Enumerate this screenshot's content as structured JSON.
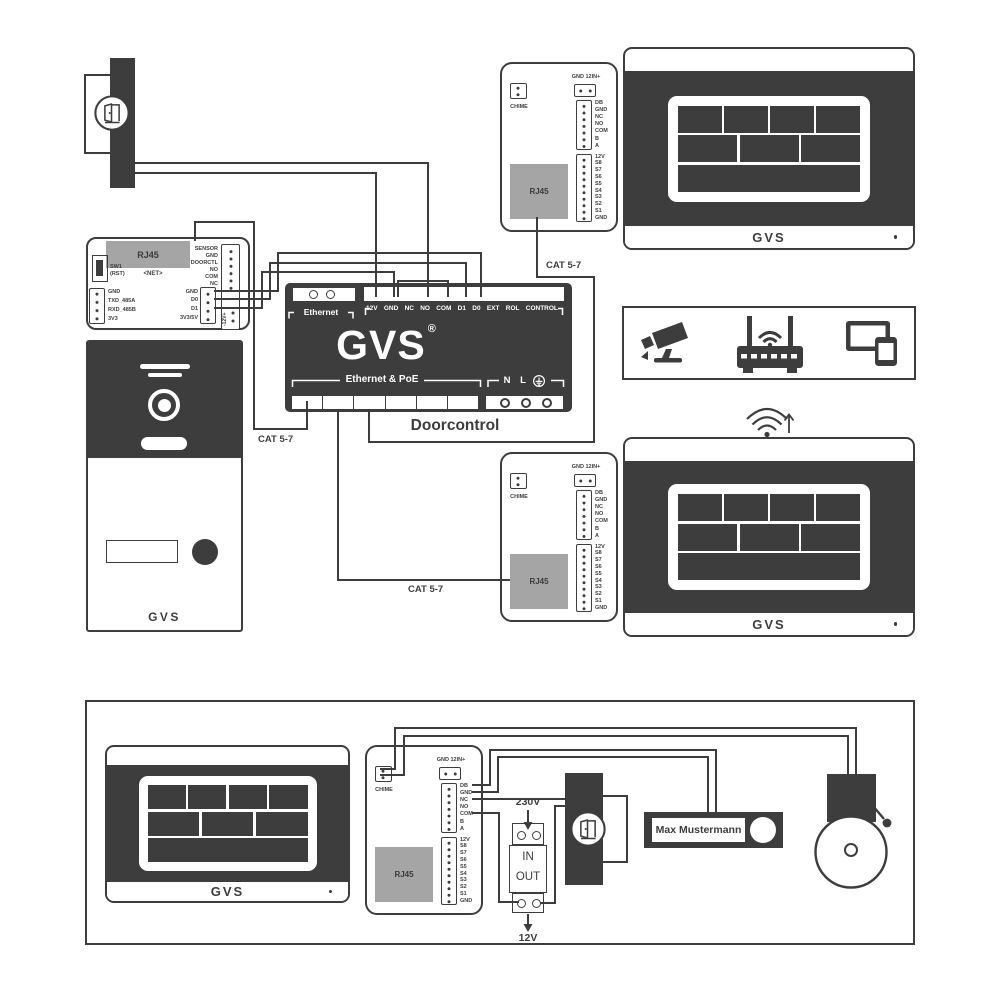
{
  "colors": {
    "ink": "#3d3d3d",
    "module_gray": "#a5a5a5",
    "background": "#ffffff"
  },
  "labels": {
    "cat": "CAT 5-7"
  },
  "module": {
    "rj45": "RJ45",
    "net": "<NET>",
    "sw1": "SW1",
    "rst": "(RST)",
    "uart_pins": [
      "GND",
      "TXD_485A",
      "RXD_485B",
      "3V3"
    ],
    "io_pins": [
      "SENSOR",
      "GND",
      "DOORCTL",
      "NO",
      "COM",
      "NC"
    ],
    "data_pins": [
      "GND",
      "D0",
      "D1",
      "3V3/5V"
    ],
    "power_vertical": "-12V+"
  },
  "doorcontrol": {
    "ethernet": "Ethernet",
    "top_pins": [
      "12V",
      "GND",
      "NC",
      "NO",
      "COM",
      "D1",
      "D0",
      "EXT",
      "ROL",
      "CONTROL"
    ],
    "logo": "GVS",
    "logo_reg": "®",
    "poe": "Ethernet & PoE",
    "mains_pins": [
      "N",
      "L"
    ],
    "caption": "Doorcontrol"
  },
  "connbox": {
    "chime": "CHIME",
    "power": "GND 12IN+",
    "bus_pins": [
      "DB",
      "GND",
      "NC",
      "NO",
      "COM",
      "B",
      "A"
    ],
    "scene_pins": [
      "12V",
      "S8",
      "S7",
      "S6",
      "S5",
      "S4",
      "S3",
      "S2",
      "S1",
      "GND"
    ],
    "rj45": "RJ45"
  },
  "door_station": {
    "brand": "GVS"
  },
  "monitor": {
    "brand": "GVS"
  },
  "power_supply": {
    "input": "230V",
    "in": "IN",
    "out": "OUT",
    "output": "12V"
  },
  "doorbell": {
    "name": "Max Mustermann"
  }
}
